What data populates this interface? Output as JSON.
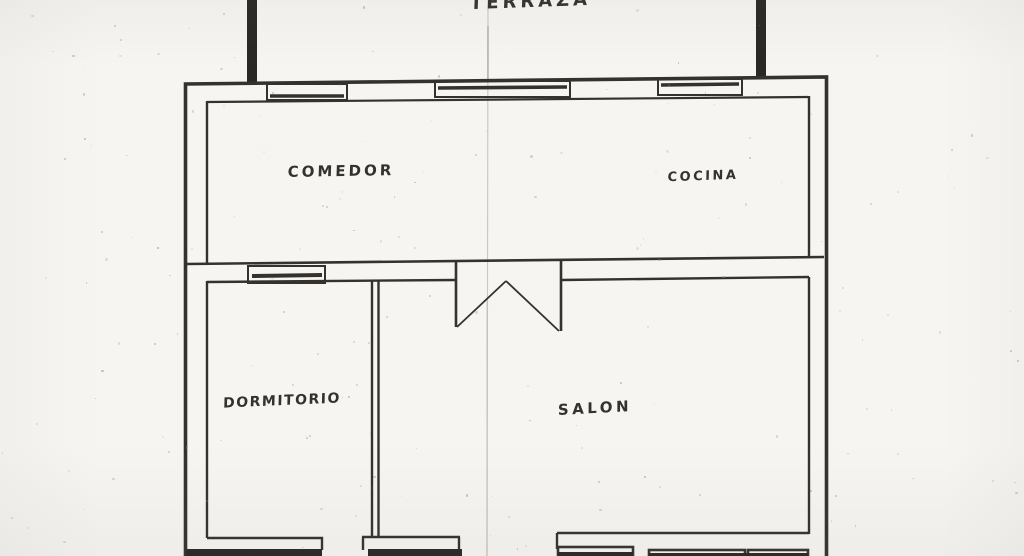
{
  "document": {
    "kind": "scanned hand-drawn apartment floor plan"
  },
  "rooms": {
    "terraza": "TERRAZA",
    "comedor": "COMEDOR",
    "cocina": "COCINA",
    "dormitorio": "DORMITORIO",
    "salon": "SALON"
  },
  "colors": {
    "ink": "#35322e",
    "ink_dark": "#2a2825",
    "paper": "#f6f5f2",
    "crease": "#c6c2ba"
  }
}
